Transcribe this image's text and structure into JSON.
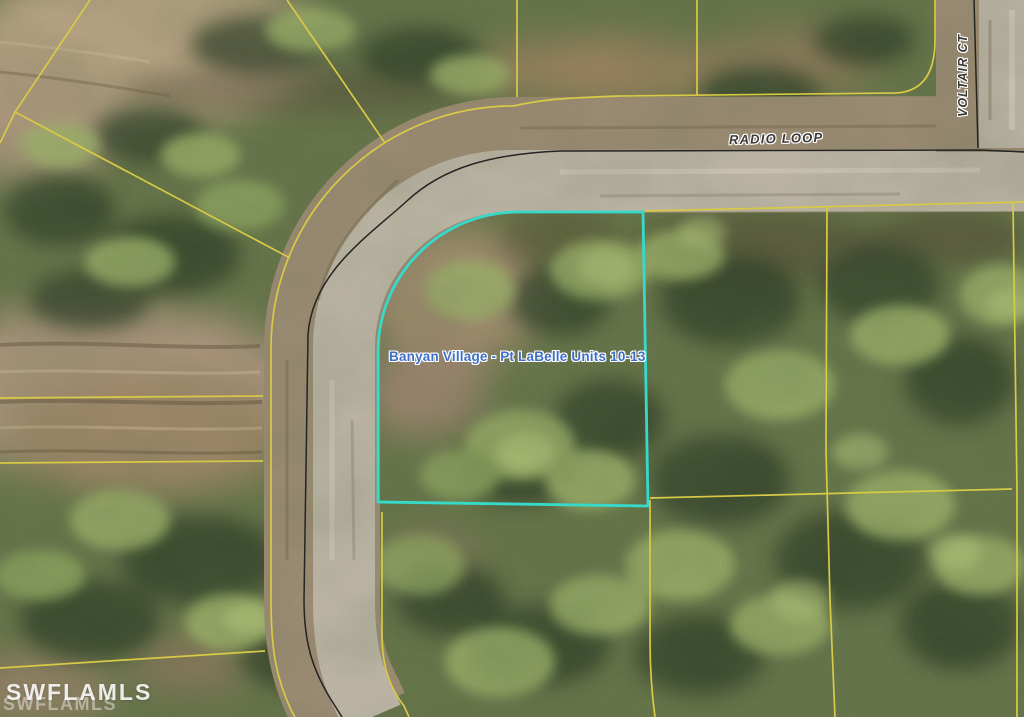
{
  "image": {
    "type": "aerial-parcel-map",
    "labels": {
      "street_horizontal": "RADIO LOOP",
      "street_vertical": "VOLTAIR CT",
      "subdivision": "Banyan Village - Pt LaBelle Units 10-13"
    },
    "watermark": {
      "primary": "SWFLAMLS",
      "echo": "SWFLAMLS"
    },
    "colors": {
      "highlight_boundary": "#36d9ca",
      "parcel_line": "#d8ca45",
      "road_edge_line": "#242424",
      "road_shoulder": "#9a8a72",
      "road_pavement": "#bab3a3",
      "street_label_text": "#3a3a3a",
      "subdivision_label_text": "#3f6ec6",
      "watermark_text": "#ffffff",
      "vegetation_base": "#66744a"
    }
  }
}
